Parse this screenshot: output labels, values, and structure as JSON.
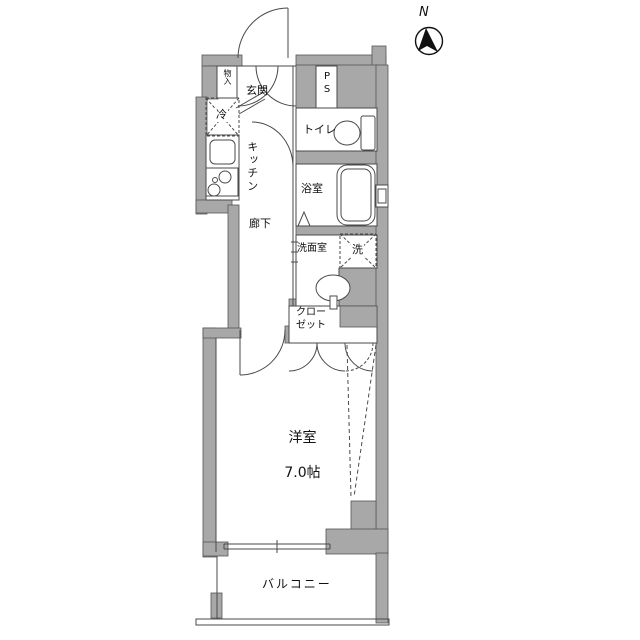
{
  "floorplan": {
    "compass_label": "N",
    "labels": {
      "entrance": "玄関",
      "storage": "物入",
      "pipe_space": "PS",
      "toilet": "トイレ",
      "refrigerator": "冷",
      "kitchen": "キッチン",
      "bathroom": "浴室",
      "hallway": "廊下",
      "washroom": "洗面室",
      "washer": "洗",
      "closet": "クロー\nゼット",
      "main_room_name": "洋室",
      "main_room_size": "7.0帖",
      "balcony": "バルコニー"
    },
    "colors": {
      "wall_fill": "#a8a8a8",
      "line": "#4a4a4a",
      "text": "#111111",
      "background": "#ffffff"
    }
  }
}
